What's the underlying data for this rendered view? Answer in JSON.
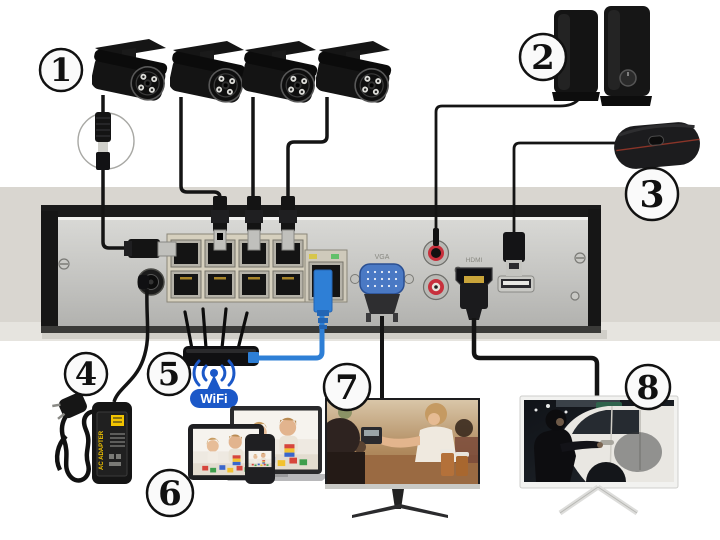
{
  "callouts": [
    "1",
    "2",
    "3",
    "4",
    "5",
    "6",
    "7",
    "8"
  ],
  "wifi": {
    "label": "WiFi"
  },
  "adapter": {
    "label": "AC ADAPTER"
  },
  "ports": {
    "vga": "VGA",
    "hdmi": "HDMI"
  },
  "colors": {
    "cable-blue": "#2e7fd6",
    "cable-blue-dark": "#2465b4",
    "wifi-blue": "#1b58c8",
    "vga-blue": "#4a79c4",
    "rca-red": "#c8303c",
    "adapter-yellow": "#f2c400",
    "surface-gray": "#d9d6d0",
    "cable-black": "#141414"
  }
}
